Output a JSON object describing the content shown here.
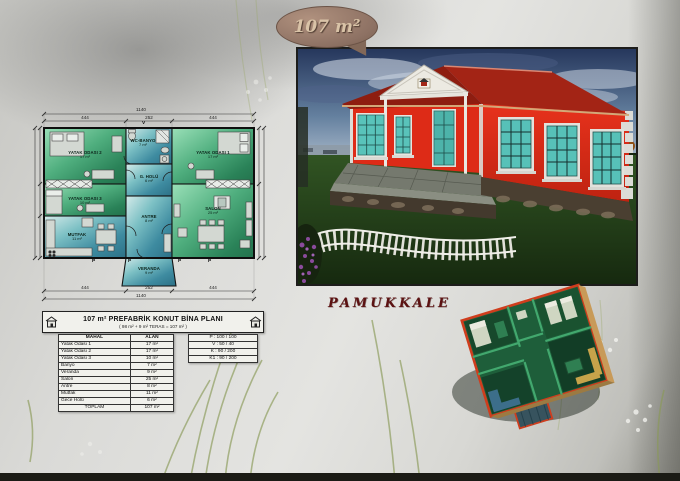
{
  "badge": {
    "area_label": "107 m²"
  },
  "location": {
    "label": "PAMUKKALE"
  },
  "floor_plan": {
    "rooms": {
      "yatak_odasi_2": {
        "name": "YATAK ODASI 2",
        "area": "17 m²"
      },
      "yatak_odasi_3": {
        "name": "YATAK ODASI 3",
        "area": "10 m²"
      },
      "mutfak": {
        "name": "MUTFAK",
        "area": "11 m²"
      },
      "wc_banyo": {
        "name": "WC-BANYO",
        "area": "7 m²"
      },
      "g_holu": {
        "name": "G. HOLÜ",
        "area": "6 m²"
      },
      "antre": {
        "name": "ANTRE",
        "area": "8 m²"
      },
      "veranda": {
        "name": "VERANDA",
        "area": "9 m²"
      },
      "yatak_odasi_1": {
        "name": "YATAK ODASI 1",
        "area": "17 m²"
      },
      "salon": {
        "name": "SALON",
        "area": "25 m²"
      }
    },
    "dimensions": {
      "total_width": "1140",
      "seg_left": "444",
      "seg_mid": "252",
      "seg_right": "444",
      "vent_mark": "V",
      "window_mark": "P"
    }
  },
  "title_block": {
    "title": "107 m² PREFABRİK KONUT BİNA PLANI",
    "subtitle": "( 98 m² + 9 m² TERAS = 107 m² )",
    "table": {
      "headers": [
        "MAHAL",
        "ALAN"
      ],
      "rows": [
        [
          "Yatak Odası 1",
          "17 m²"
        ],
        [
          "Yatak Odası 2",
          "17 m²"
        ],
        [
          "Yatak Odası 3",
          "10 m²"
        ],
        [
          "Banyo",
          "7 m²"
        ],
        [
          "Veranda",
          "9 m²"
        ],
        [
          "Salon",
          "25 m²"
        ],
        [
          "Antre",
          "8 m²"
        ],
        [
          "Mutfak",
          "11 m²"
        ],
        [
          "Gece Holü",
          "6 m²"
        ]
      ],
      "total_label": "TOPLAM",
      "total_value": "107 m²"
    }
  },
  "schedule": {
    "rows": [
      "P : 100 / 100",
      "V : 50 / 40",
      "K : 90 / 200",
      "K1 : 90 / 200"
    ]
  },
  "colors": {
    "badge_brown": "#8d7163",
    "house_red": "#e22d18",
    "roof_red": "#9b2213",
    "window_teal": "#59c3ba",
    "plan_green": "#4fae7e",
    "plan_steel": "#4a8fa0",
    "location_maroon": "#5c1212"
  }
}
